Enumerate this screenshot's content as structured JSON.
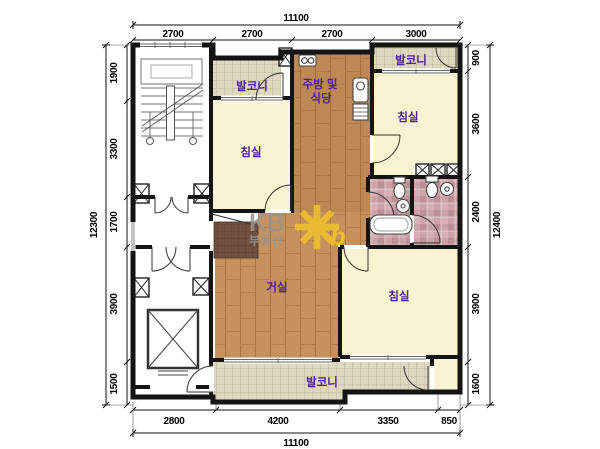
{
  "rooms": {
    "balcony": "발코니",
    "bedroom": "침실",
    "living": "거실",
    "kitchen_line1": "주방 및",
    "kitchen_line2": "식당"
  },
  "dims": {
    "top": {
      "total": "11100",
      "segs": [
        "2700",
        "2700",
        "2700",
        "3000"
      ]
    },
    "bottom": {
      "total": "11100",
      "segs": [
        "2800",
        "4200",
        "3350",
        "850"
      ]
    },
    "left": {
      "total": "12300",
      "segs": [
        "1900",
        "3300",
        "1700",
        "3900",
        "1500"
      ]
    },
    "right": {
      "total": "12400",
      "segs": [
        "900",
        "3600",
        "2400",
        "3900",
        "1600"
      ]
    }
  },
  "watermark": {
    "brand": "KB",
    "sub": "부동산",
    "accent_letter": "b"
  },
  "colors": {
    "wall": "#141414",
    "room_label": "#4b1da0",
    "wood_floor": "#c6915c",
    "bedroom_cream": "#faf3d2",
    "balcony_tile": "#ded8c0",
    "bath_tile": "#cba2aa",
    "entrance_tile": "#70503f",
    "watermark_yellow": "#eebe2f",
    "watermark_gray": "#9c948c"
  }
}
